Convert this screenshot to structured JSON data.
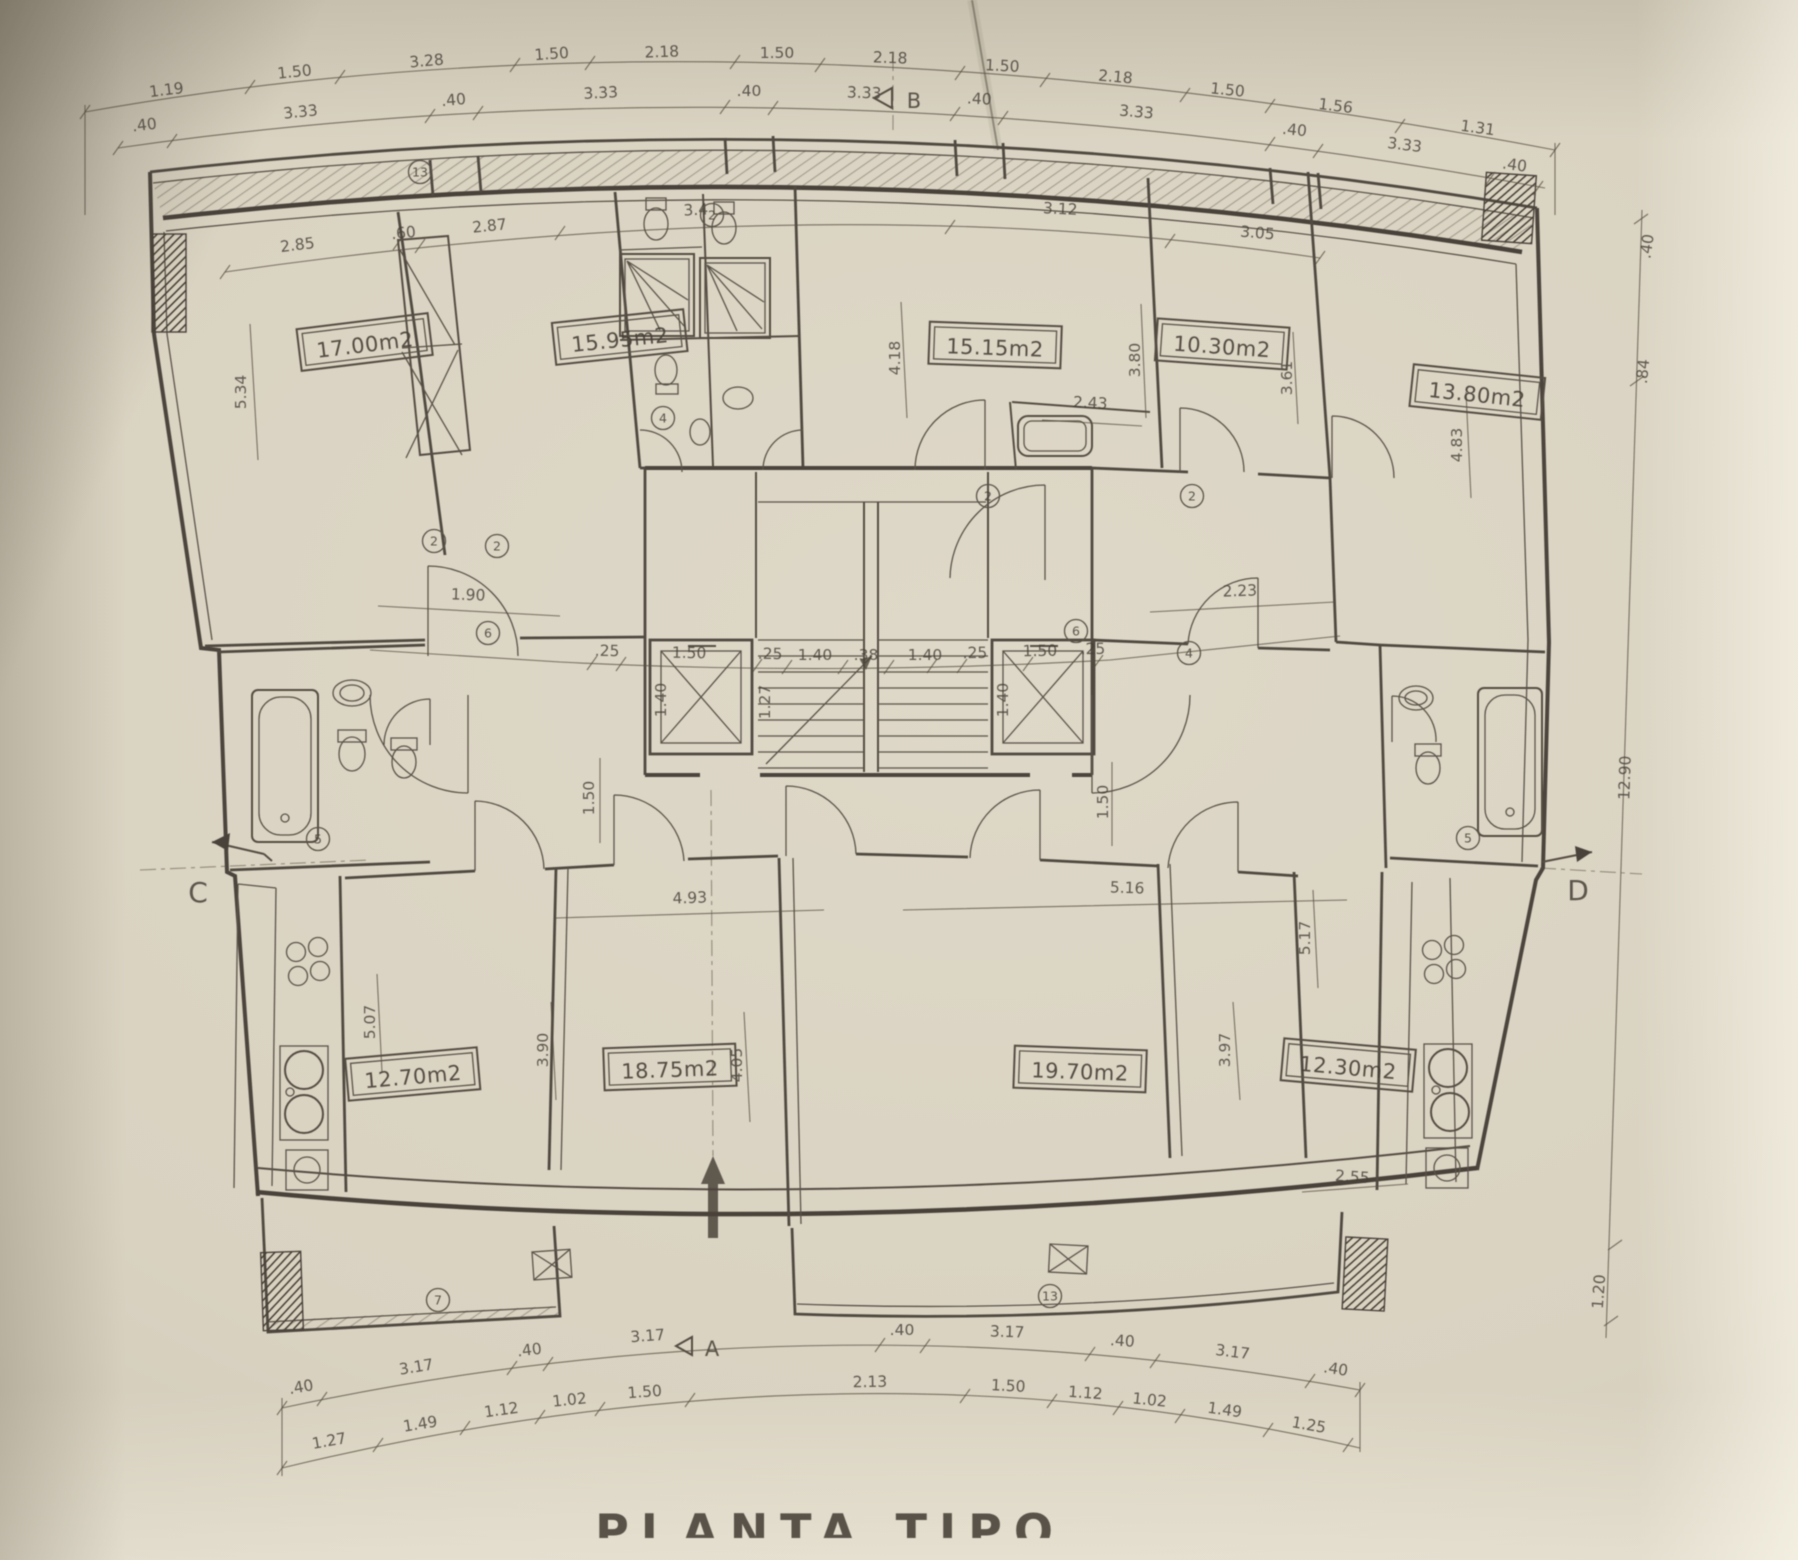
{
  "title": "PLANTA TIPO",
  "rooms": [
    {
      "area": "17.00m2"
    },
    {
      "area": "15.95m2"
    },
    {
      "area": "15.15m2"
    },
    {
      "area": "10.30m2"
    },
    {
      "area": "13.80m2"
    },
    {
      "area": "12.70m2"
    },
    {
      "area": "18.75m2"
    },
    {
      "area": "19.70m2"
    },
    {
      "area": "12.30m2"
    }
  ],
  "markers": {
    "top": "B",
    "bottom": "A",
    "left": "C",
    "right": "D"
  },
  "dims": {
    "top_upper": [
      "1.19",
      "1.50",
      "3.28",
      "1.50",
      "2.18",
      "1.50",
      "2.18",
      "1.50",
      "2.18",
      "1.50",
      "1.56",
      "1.31"
    ],
    "top_lower": [
      ".40",
      "3.33",
      ".40",
      "3.33",
      ".40",
      "3.33",
      ".40",
      "3.33",
      ".40",
      "3.33",
      ".40"
    ],
    "bottom_inner": [
      ".40",
      "3.17",
      ".40",
      "3.17",
      ".40",
      "3.17",
      ".40",
      "3.17",
      ".40"
    ],
    "bottom_outer": [
      "1.27",
      "1.49",
      "1.12",
      "1.02",
      "1.50",
      "2.13",
      "1.50",
      "1.12",
      "1.02",
      "1.49",
      "1.25"
    ],
    "core": [
      ".25",
      "1.50",
      ".25",
      "1.40",
      ".38",
      "1.40",
      ".25",
      "1.50",
      ".25"
    ],
    "interior": [
      "2.85",
      ".60",
      "2.87",
      "3.4",
      "3.12",
      "3.05",
      "5.34",
      "4.18",
      "3.80",
      "3.61",
      "2.43",
      "4.83",
      "1.90",
      "2.23",
      "4.93",
      "5.16",
      "1.50",
      "1.50",
      "4.05",
      "3.90",
      "3.97",
      "5.07",
      "5.17",
      "2.55"
    ],
    "stair": [
      "1.40",
      "1.27",
      "1.40"
    ],
    "right_edge": [
      ".40",
      ".84",
      "12.90",
      "1.20"
    ]
  },
  "tags": [
    "13",
    "2",
    "2",
    "2",
    "2",
    "2",
    "4",
    "6",
    "6",
    "4",
    "5",
    "5",
    "7",
    "13"
  ]
}
